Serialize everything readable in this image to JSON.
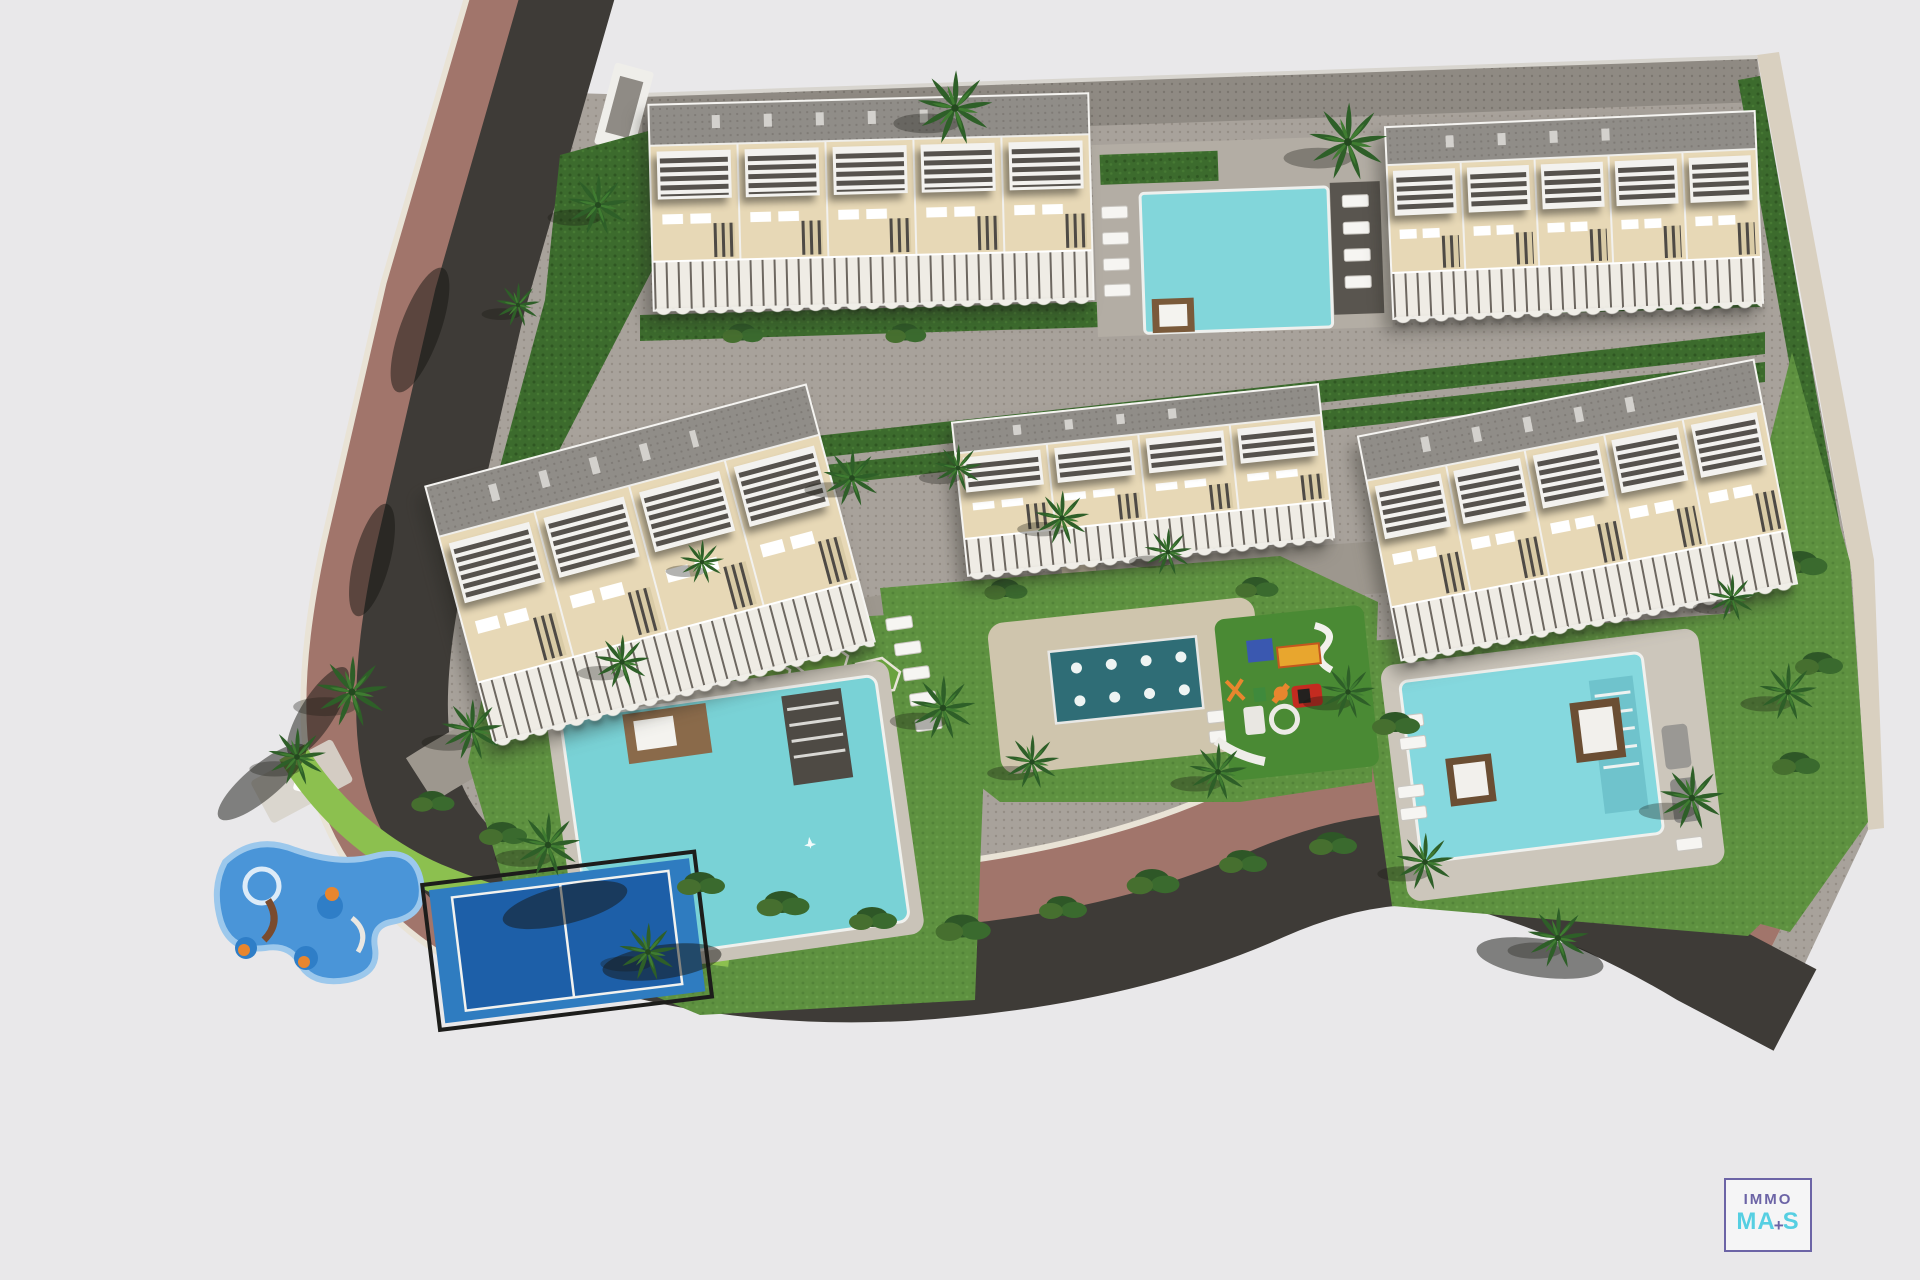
{
  "watermark": {
    "line1": "IMMO",
    "line2_prefix": "MA",
    "plus": "+",
    "line2_suffix": "S"
  },
  "palette": {
    "background": "#e9e8ea",
    "road": "#3e3b37",
    "sidewalk": "#a1756b",
    "curb": "#e9e3d6",
    "site_paving": "#a8a29b",
    "building_facade": "#e7d8b6",
    "building_roof": "#908d88",
    "lawn": "#5e9140",
    "hedge": "#3c6b2d",
    "pool_water": "#82d6da",
    "splash_pool": "#2f6d76",
    "paddle_court_outer": "#2f7cc0",
    "paddle_court_inner": "#1d5fa8",
    "playground_blue": "#4a95d8",
    "playground_orange": "#e8862e",
    "logo_purple": "#6c64a6",
    "logo_cyan": "#56cfe2"
  },
  "scene": {
    "type": "aerial-3d-site-plan-render",
    "elements": [
      "five apartment buildings with roof pergolas and balconies",
      "rooftop pool between top buildings",
      "large main swimming pool",
      "splash fountain pool with eight jets",
      "east swimming pool with sun loungers",
      "children playground with slides",
      "kids water playground with spring riders",
      "paddle tennis court",
      "perimeter road with sidewalk",
      "palm trees, hedges and lawns",
      "entrance gate and crossing"
    ]
  }
}
